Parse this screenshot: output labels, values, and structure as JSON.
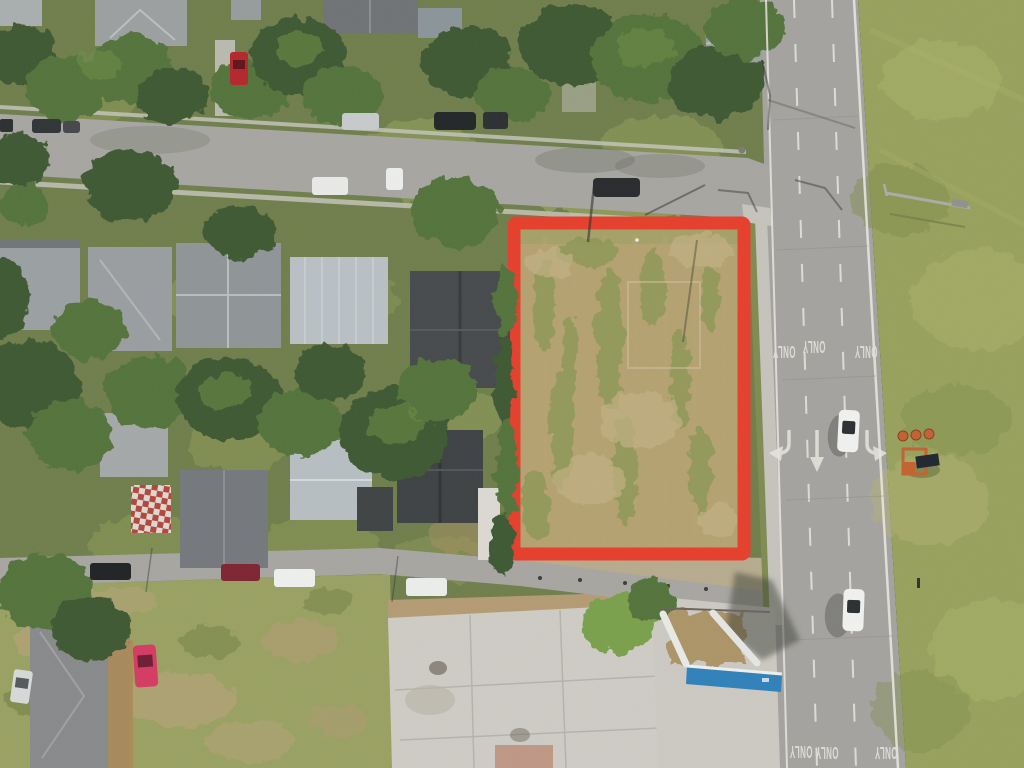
{
  "scene": {
    "type": "aerial-drone-photo",
    "subject": "Vacant corner lot outlined in red beside a multi-lane arterial road, surrounded by a residential neighborhood, a demolished gas station pad and a grass field",
    "lot_outline_shape": "rectangle",
    "vehicle_count_on_road": 2,
    "traffic_barrel_count": 3
  },
  "road_markings": {
    "only_labels": [
      "ONLY",
      "ONLY",
      "ONLY",
      "ONLY",
      "ONLY",
      "ONLY"
    ],
    "lane_arrows": [
      "left-turn-arrow",
      "straight-arrow",
      "right-turn-arrow"
    ]
  },
  "colors": {
    "neighborhood_green": "#6f7e4b",
    "yard_light": "#8a9757",
    "side_street_gray": "#a7a5a1",
    "main_road_gray": "#a5a3a0",
    "lane_white": "#e8e6df",
    "grass_field": "#98a15c",
    "scrub_field": "#9aa162",
    "lot_ground": "#b4a170",
    "lot_outline_red": "#e63e2b",
    "concrete_pad": "#ceccc5",
    "dirt_tan": "#b49b74",
    "sidewalk_gray": "#c6c3bc",
    "tree_dark": "#3e5930",
    "tree_mid": "#53733a",
    "tree_light": "#6d9046",
    "roof_gray": "#979b9d",
    "roof_silver": "#b8c0c5",
    "roof_charcoal": "#45494b",
    "canopy_blue": "#2f80ba",
    "cone_orange": "#c2612f",
    "car_white": "#f1f2f0",
    "car_silver": "#c7cacc",
    "car_dark": "#27292c",
    "car_red": "#b3262c",
    "car_maroon": "#7e2330",
    "car_pink": "#d63a62",
    "shadow_dark": "#31382c"
  }
}
